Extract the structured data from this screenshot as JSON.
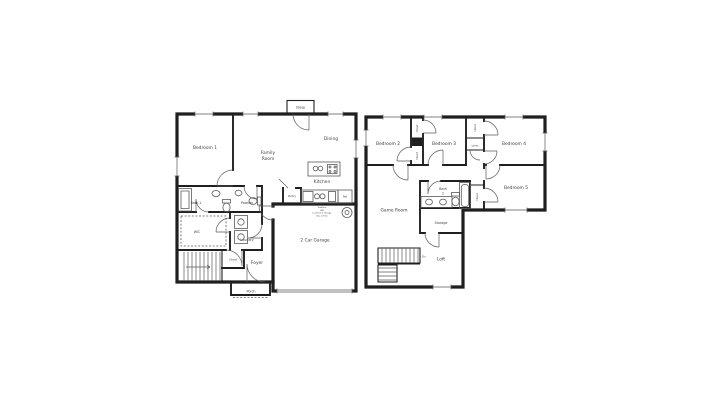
{
  "colors": {
    "wall": "#1f1f1f",
    "line": "#5a5a5a",
    "text": "#424242",
    "bg": "#ffffff"
  },
  "floor1": {
    "labels": {
      "stoop": "Stoop",
      "bedroom1": "Bedroom 1",
      "family1": "Family",
      "family2": "Room",
      "dining": "Dining",
      "kitchen": "Kitchen",
      "pantry": "Pantry",
      "ref": "Ref",
      "bath1": "Bath 1",
      "powder": "Powder",
      "wic": "WIC",
      "laundry": "Laundry",
      "closet": "Closet",
      "foyer": "Foyer",
      "porch": "Porch",
      "garage": "2 Car Garage",
      "note1": "Tankless",
      "note2": "WH",
      "note3": "Located in Garage",
      "note4": "Gas or Elec"
    }
  },
  "floor2": {
    "labels": {
      "bedroom2": "Bedroom 2",
      "bedroom3": "Bedroom 3",
      "bedroom4": "Bedroom 4",
      "bedroom5": "Bedroom 5",
      "game_room": "Game Room",
      "bath2_line1": "Bath",
      "bath2_line2": "2",
      "linen": "Linen",
      "closet": "Closet",
      "storage": "Storage",
      "loft": "Loft",
      "dn": "Dn"
    }
  }
}
